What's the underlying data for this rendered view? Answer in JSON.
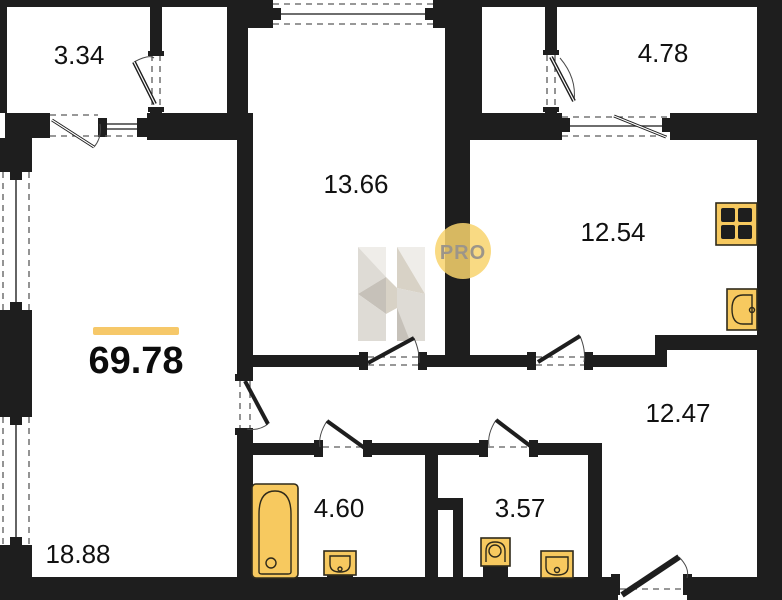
{
  "plan": {
    "total": {
      "area": "69.78"
    },
    "rooms": [
      {
        "key": "balcony-top-left",
        "area": "3.34"
      },
      {
        "key": "room-center",
        "area": "13.66"
      },
      {
        "key": "balcony-top-right",
        "area": "4.78"
      },
      {
        "key": "kitchen",
        "area": "12.54"
      },
      {
        "key": "living-room",
        "area": "18.88"
      },
      {
        "key": "bathroom",
        "area": "4.60"
      },
      {
        "key": "wc",
        "area": "3.57"
      },
      {
        "key": "hall",
        "area": "12.47"
      }
    ],
    "logo": {
      "badge": "PRO"
    },
    "colors": {
      "wall": "#1e1e1e",
      "accent": "#f7c95f",
      "accent_bar": "#f6c869",
      "badge_fill": "#f8d36d",
      "logo_grey": "#9c9589",
      "logo_face_light": "#efede9",
      "logo_face_mid": "#dedbd5",
      "logo_face_dark": "#c6c1b9",
      "logo_face_warm": "#d8d2c6",
      "paper": "#ffffff"
    }
  }
}
